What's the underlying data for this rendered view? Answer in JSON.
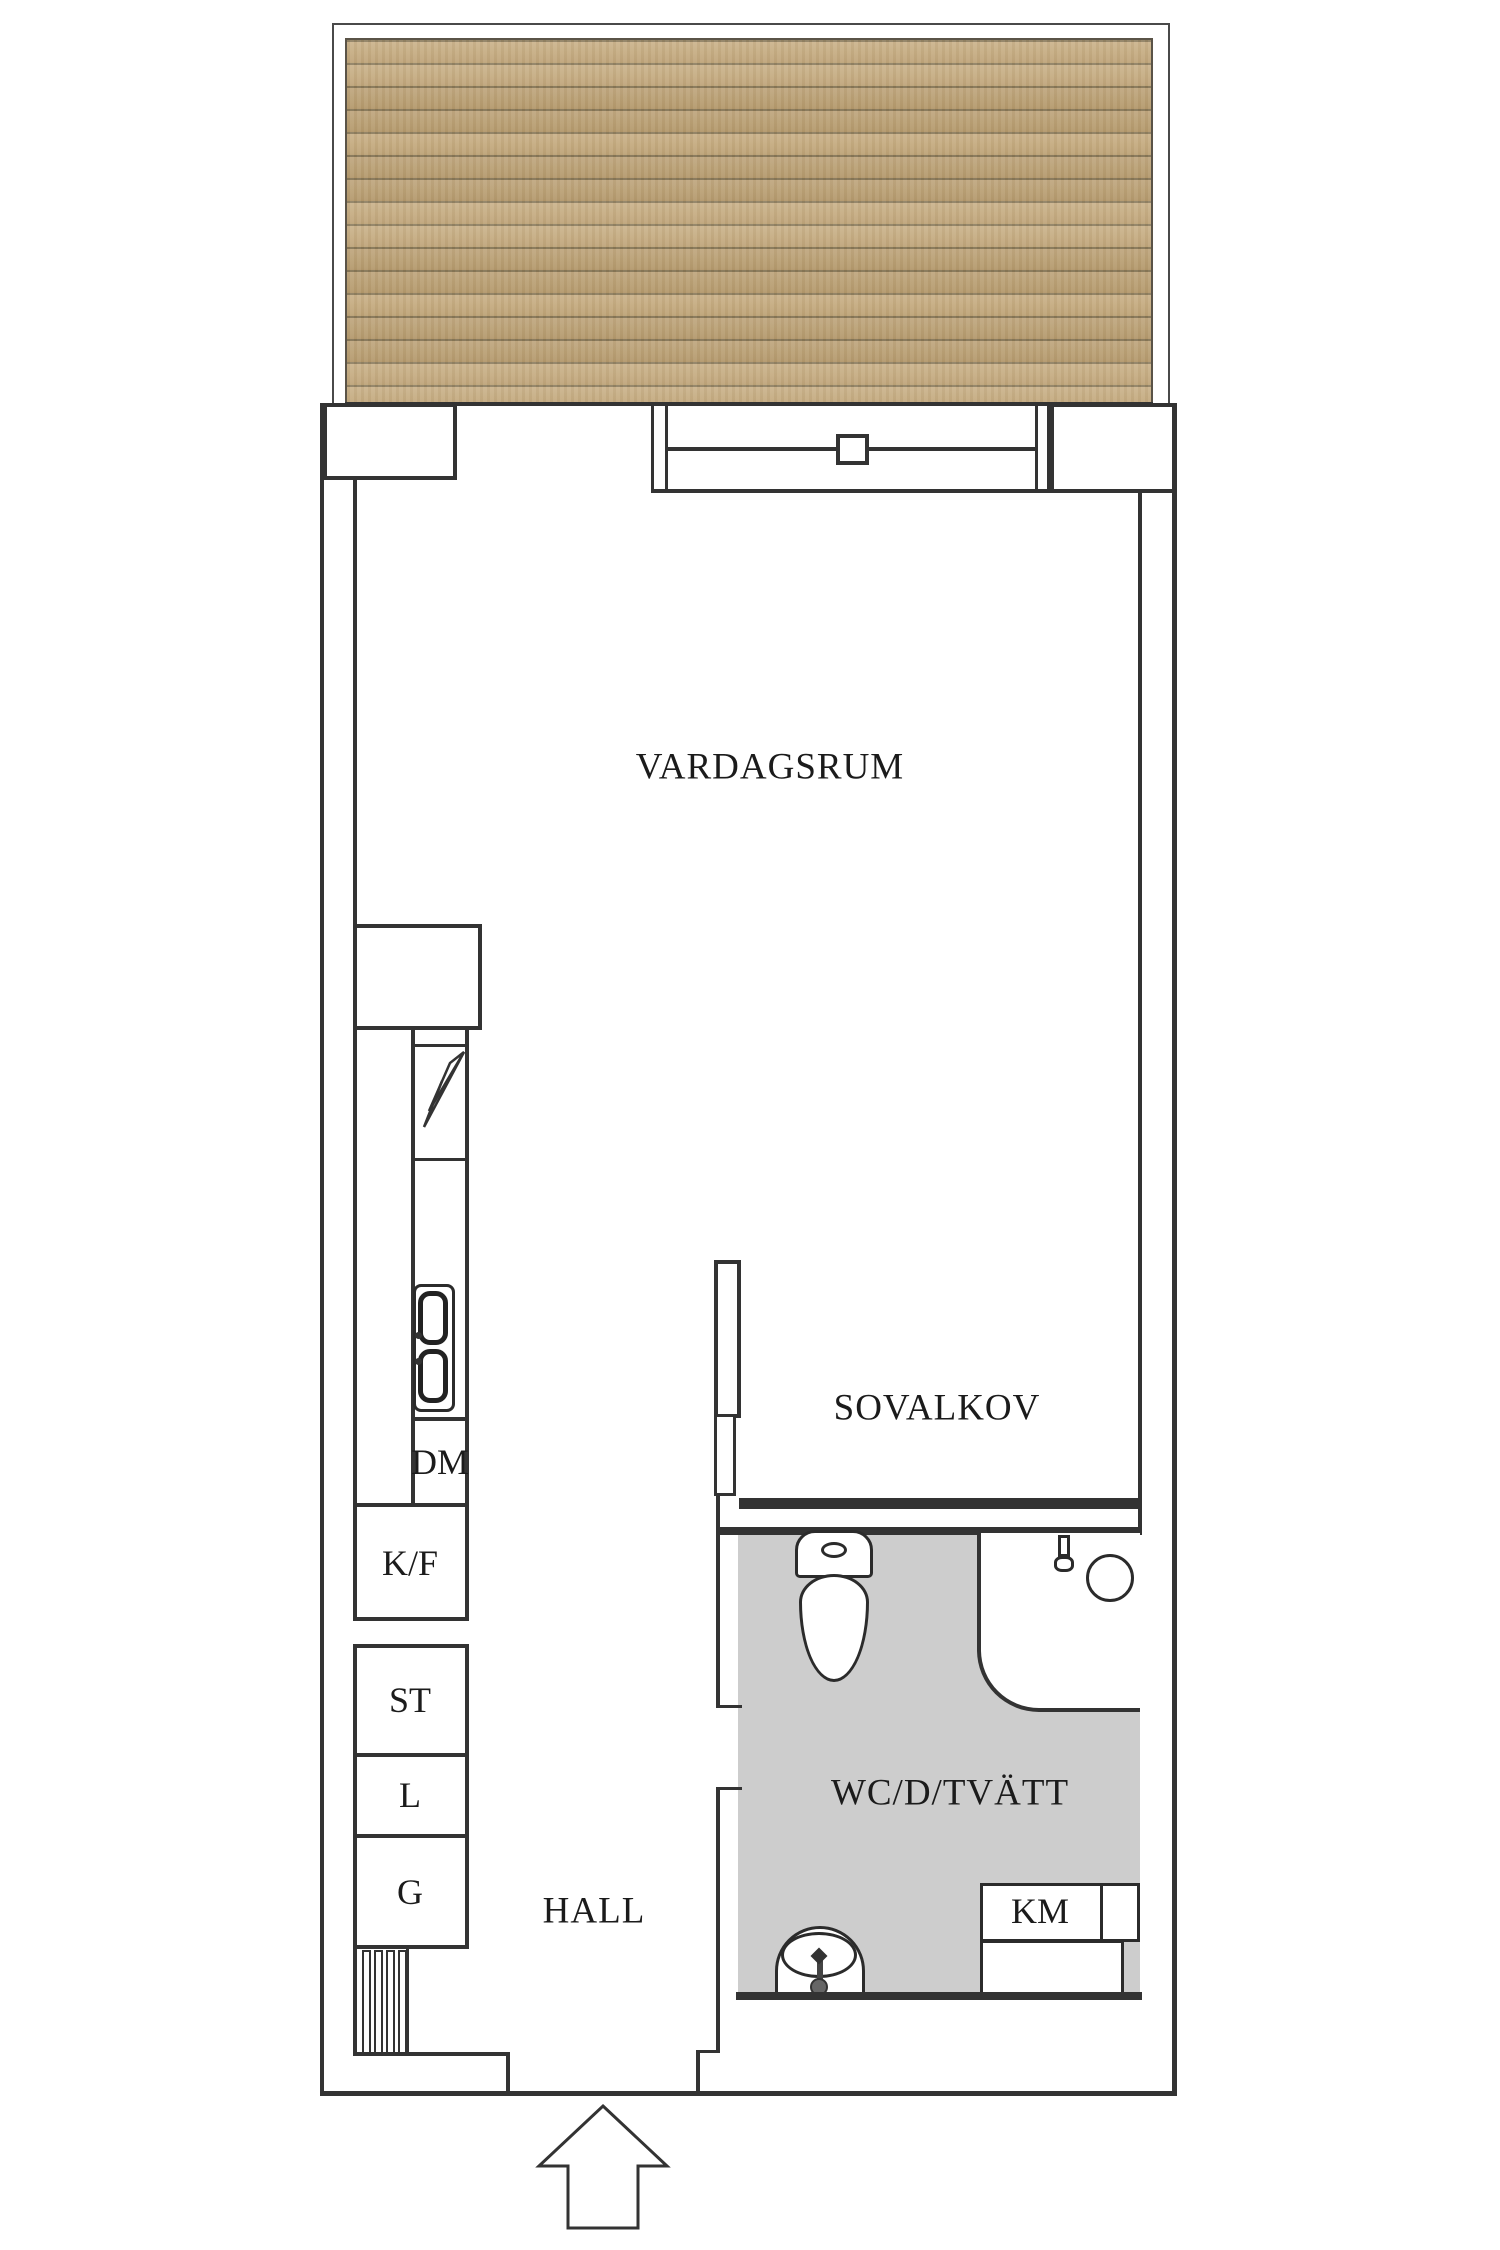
{
  "plan": {
    "rooms": {
      "living": {
        "label": "VARDAGSRUM"
      },
      "sleeping_alcove": {
        "label": "SOVALKOV"
      },
      "bathroom": {
        "label": "WC/D/TVÄTT"
      },
      "hall": {
        "label": "HALL"
      }
    },
    "appliances": {
      "dishwasher": {
        "label": "DM"
      },
      "fridge_freezer": {
        "label": "K/F"
      },
      "cleaning_cabinet": {
        "label": "ST"
      },
      "linen_cabinet": {
        "label": "L"
      },
      "wardrobe": {
        "label": "G"
      },
      "washing_machine": {
        "label": "KM"
      }
    },
    "colors": {
      "wall_line": "#333333",
      "fixture_line": "#2b2b2b",
      "bathroom_floor": "#cdcdcd",
      "deck_plank": "#c4aa7d",
      "deck_seam": "#8a7a5a",
      "background": "#ffffff"
    }
  }
}
